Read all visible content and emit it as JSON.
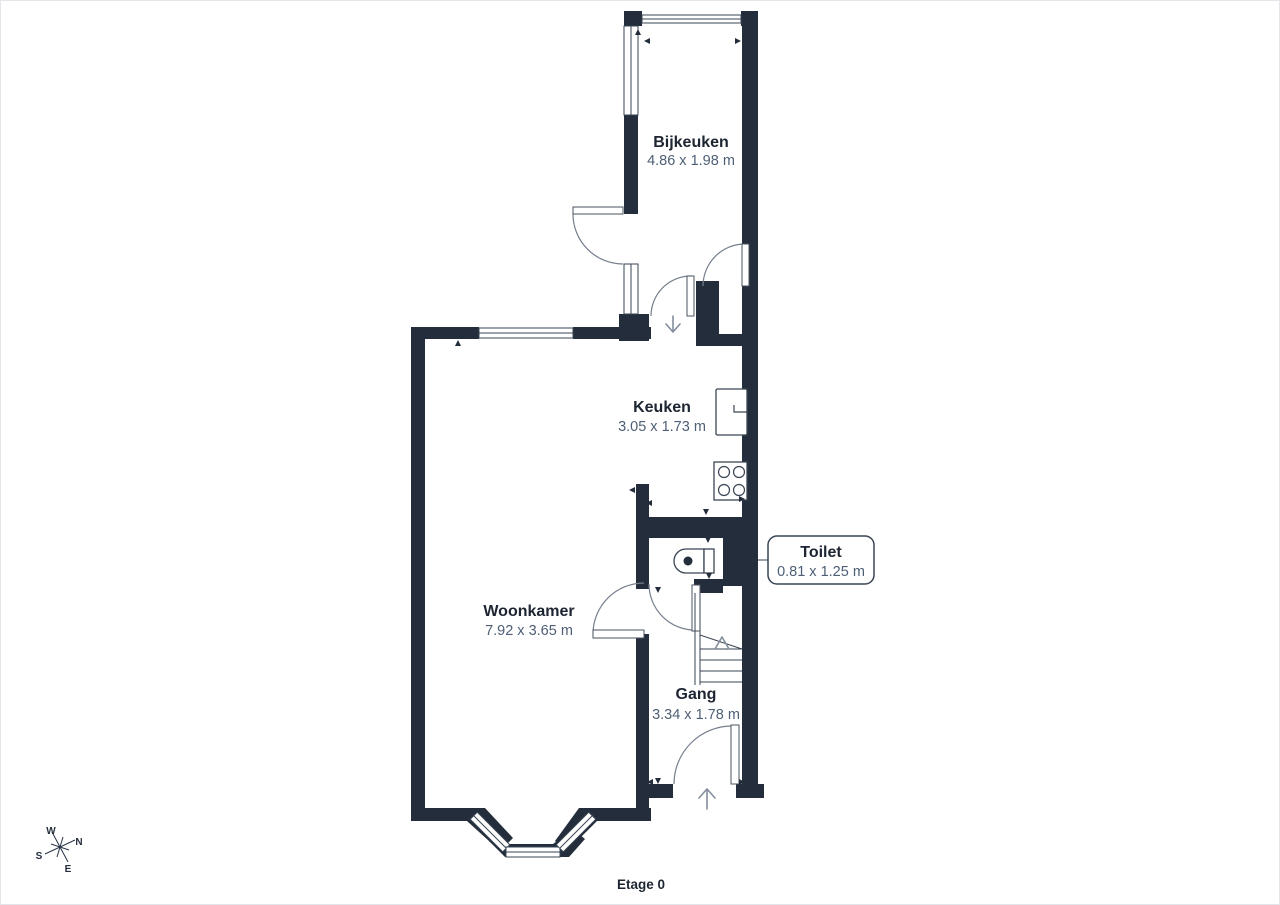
{
  "floorplan": {
    "floor_label": "Etage 0",
    "rooms": {
      "bijkeuken": {
        "name": "Bijkeuken",
        "dimensions": "4.86 x 1.98 m"
      },
      "keuken": {
        "name": "Keuken",
        "dimensions": "3.05 x 1.73 m"
      },
      "woonkamer": {
        "name": "Woonkamer",
        "dimensions": "7.92 x 3.65 m"
      },
      "gang": {
        "name": "Gang",
        "dimensions": "3.34 x 1.78 m"
      },
      "toilet": {
        "name": "Toilet",
        "dimensions": "0.81 x 1.25 m"
      }
    },
    "compass": {
      "north": "N",
      "east": "E",
      "south": "S",
      "west": "W"
    },
    "colors": {
      "wall": "#232d3b",
      "room_name_text": "#1d2532",
      "dimension_text": "#4e5f75",
      "door_arc": "#767f8d",
      "background": "#ffffff"
    }
  }
}
